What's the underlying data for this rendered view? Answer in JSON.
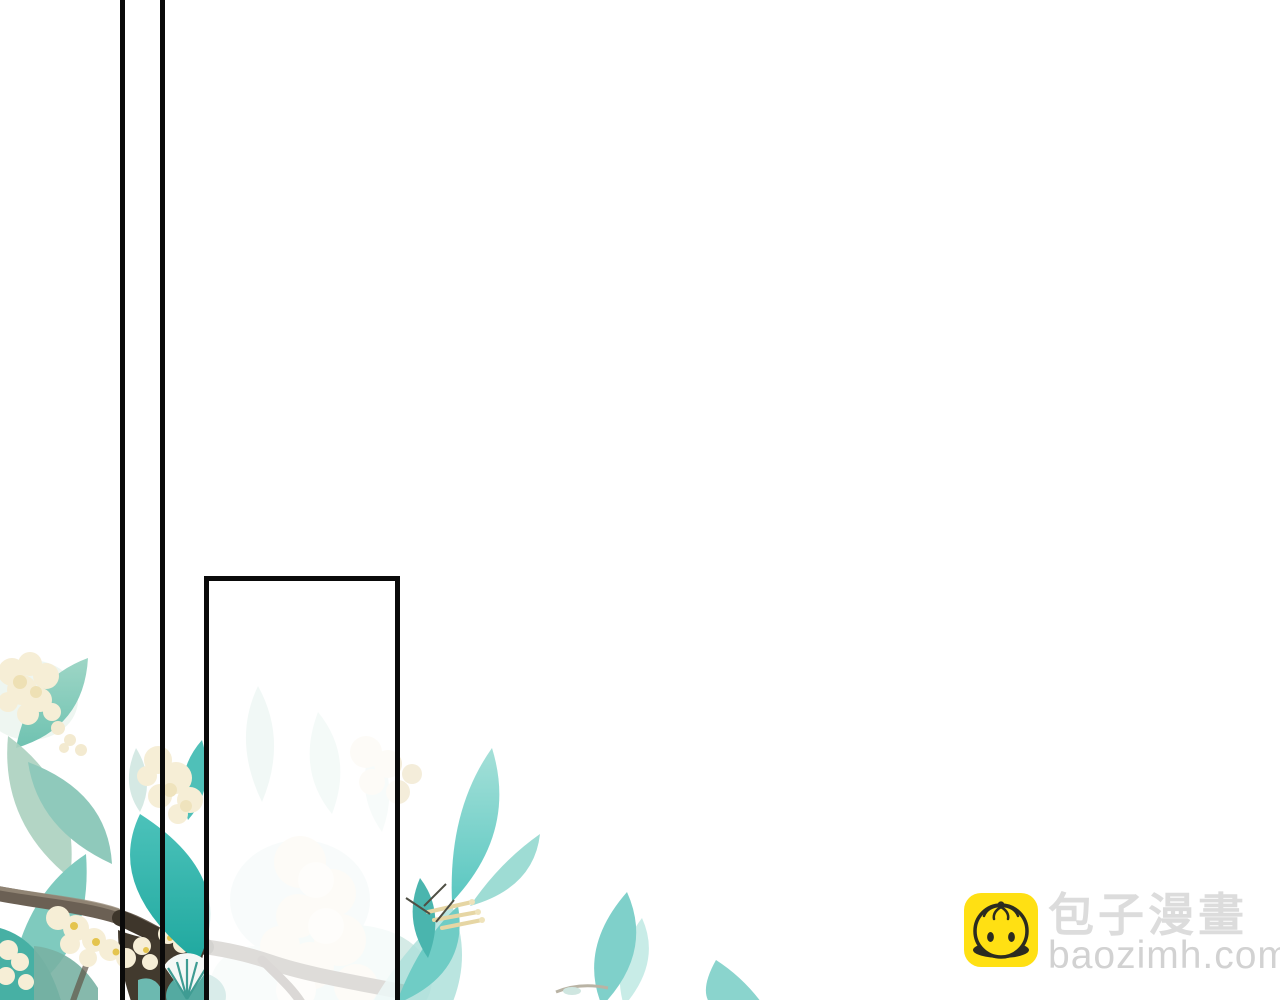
{
  "page": {
    "background": "#FFFFFF"
  },
  "panel": {
    "border_color": "#0A0A0A",
    "gutter_line_color": "#0A0A0A",
    "interior_wash": "rgba(255,255,255,0.78)"
  },
  "watermark": {
    "brand_name": "包子漫畫",
    "site_url": "baozimh.com",
    "icon": "baozi-bun-icon",
    "icon_background": "#FFE013",
    "icon_line_color": "#2B2B20",
    "brand_text_color": "#DCDCDC",
    "url_text_color": "#D2D2D2"
  },
  "artwork": {
    "description": "Watercolor tree branch with teal leaves and cream osmanthus blossoms across the bottom-left; foliage inside the open comic panel appears washed out",
    "palette": {
      "leaf_vivid_dark": "#1FA89F",
      "leaf_vivid": "#4CC2BA",
      "leaf_medium": "#7CC6B6",
      "leaf_sage": "#A9CFC0",
      "leaf_pale": "#D8ECE6",
      "branch": "#6B6054",
      "branch_dark": "#3E362B",
      "blossom_cream": "#F6EED6",
      "blossom_shade": "#EEE0B4",
      "blossom_yellow": "#E4C44E",
      "fan_teal": "#54AAA1",
      "twig_tan": "#E6D6A4"
    }
  }
}
